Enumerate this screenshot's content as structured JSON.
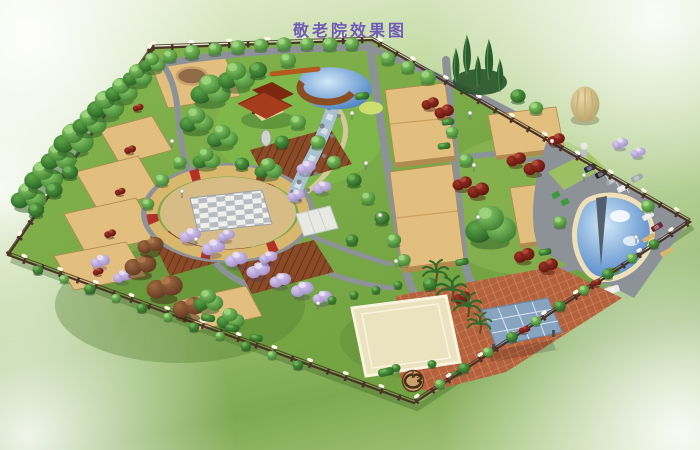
{
  "title": {
    "text": "敬老院效果图"
  },
  "colors": {
    "bg_light": "#e8f0d6",
    "bg_mid": "#aecd85",
    "bg_green": "#7ea952",
    "title_purple": "#6f5ab8",
    "lawn_a": "#84b44d",
    "lawn_b": "#6d9c3f",
    "lawn_bright": "#7fc04a",
    "lawn_dark": "#4f7a2c",
    "lawn_yellow": "#9ec45e",
    "road": "#8d9298",
    "road_light": "#a6abaf",
    "path_tan": "#cdb287",
    "path_cream": "#d5c79c",
    "plot_tan": "#e2bf7e",
    "plot_edge": "#b08a4e",
    "ring_tan": "#d9b76c",
    "ring_red": "#b23126",
    "plank_tan": "#d7bd85",
    "checker_white": "#f0f0ea",
    "checker_gray": "#b7bcc2",
    "deck_base": "#8a4a28",
    "deck_line": "#5c2c12",
    "brick": "#b4613d",
    "brick_line": "#cf8a60",
    "court_cream": "#ebe3c0",
    "court_line": "#f8f4de",
    "canopy_blue": "#84a9cb",
    "canopy_line": "#dfe9f2",
    "water_deep": "#2a66b8",
    "water_light": "#cfe8f8",
    "pond_rim": "#efe0b8",
    "roof_red": "#a63c1c",
    "roof_dark": "#7c2810",
    "wall_cream": "#e9d6a4",
    "fence_brown": "#4a3228",
    "fence_lamp": "#fdfaea",
    "tree_green_hi": "#8ecf6d",
    "tree_green_lo": "#3a7a2c",
    "tree_dark_hi": "#5ea848",
    "tree_dark_lo": "#245b22",
    "cypress": "#2a5d2d",
    "red_hi": "#a03326",
    "red_lo": "#5c130e",
    "blossom_hi": "#d8cbf0",
    "blossom_lo": "#9f8cc9",
    "autumn_hi": "#a06a40",
    "autumn_lo": "#5e3520",
    "pale_hi": "#e8d9a8",
    "pale_lo": "#b09a60",
    "stream_rock": "#7d848b",
    "stream_white": "#dce6ee",
    "car_navy": "#1e2f4e",
    "car_black": "#23262a",
    "car_white": "#e9e9e7",
    "car_silver": "#9fa6ad",
    "car_maroon": "#6e2433",
    "bus_green": "#3f9a3f"
  }
}
